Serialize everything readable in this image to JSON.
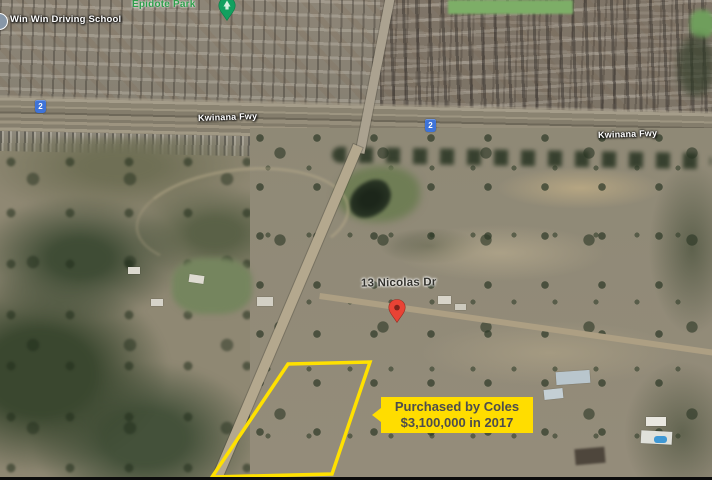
{
  "map": {
    "place_labels": {
      "driving_school": "Win Win Driving School",
      "park": "Epidote Park",
      "street": "13 Nicolas Dr"
    },
    "road_labels": {
      "freeway_west": "Kwinana Fwy",
      "freeway_east": "Kwinana Fwy"
    },
    "route_shields": [
      {
        "label": "2"
      },
      {
        "label": "2"
      }
    ],
    "callout": {
      "line1": "Purchased by Coles",
      "line2": "$3,100,000 in 2017"
    },
    "colors": {
      "callout_bg": "#FFDD00",
      "callout_text": "#4D4D4D",
      "parcel_outline": "#FFE100",
      "route_shield_bg": "#3E73D8",
      "park_label_green": "#2E9E4A",
      "location_pin_red": "#E94335"
    },
    "icons": {
      "park_pin": "park-pin-icon",
      "location_pin": "red-location-pin-icon",
      "business_dot": "business-dot-icon"
    }
  }
}
